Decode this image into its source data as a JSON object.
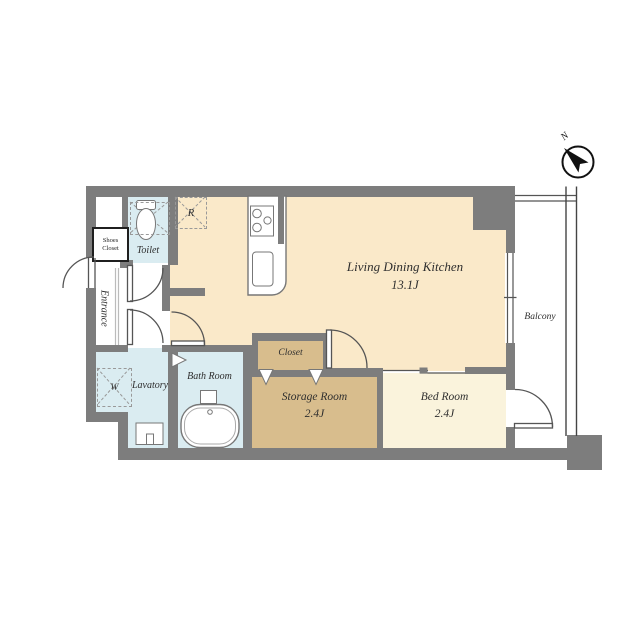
{
  "plan": {
    "compass": {
      "north_label": "N"
    },
    "rooms": {
      "ldk": {
        "name": "Living Dining Kitchen",
        "area": "13.1J"
      },
      "bedroom": {
        "name": "Bed Room",
        "area": "2.4J"
      },
      "storage_room": {
        "name": "Storage Room",
        "area": "2.4J"
      },
      "closet": {
        "name": "Closet"
      },
      "bath_room": {
        "name": "Bath Room"
      },
      "lavatory": {
        "name": "Lavatory"
      },
      "toilet": {
        "name": "Toilet"
      },
      "entrance": {
        "name": "Entrance"
      },
      "balcony": {
        "name": "Balcony"
      },
      "shoes_closet": {
        "line1": "Shoes",
        "line2": "Closet"
      }
    },
    "symbols": {
      "refrigerator": "R",
      "washing_machine": "W"
    },
    "colors": {
      "wall": "#7d7d7d",
      "ldk": "#fae9c9",
      "bedroom": "#faf3dc",
      "storage": "#d8bd8d",
      "water": "#daecf1",
      "line": "#555555",
      "text": "#2e2e2e"
    }
  }
}
